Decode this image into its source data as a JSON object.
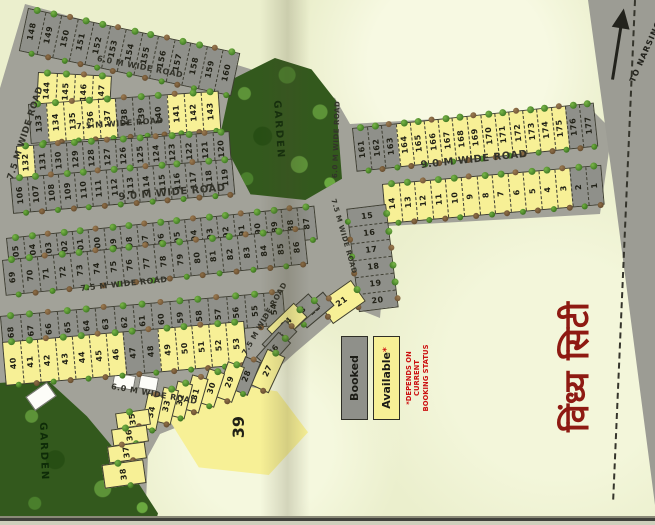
{
  "title": {
    "text": "विंध्य सिटी"
  },
  "direction_sign": {
    "text": "TO NARSINGHPUR"
  },
  "legend": {
    "booked": "Booked",
    "available": "Available",
    "available_mark": "*",
    "note_line1": "*DEPENDS ON CURRENT",
    "note_line2": "BOOKING STATUS"
  },
  "gardens": [
    {
      "label": "GARDEN"
    },
    {
      "label": "GARDEN"
    }
  ],
  "roads": [
    {
      "id": "road-top",
      "label": "6.0 M WIDE ROAD"
    },
    {
      "id": "road-75-upper",
      "label": "7.5 M WIDE ROAD"
    },
    {
      "id": "road-90-left",
      "label": "9.0 M WIDE ROAD"
    },
    {
      "id": "road-75-mid",
      "label": "7.5 M WIDE ROAD"
    },
    {
      "id": "road-60-lower",
      "label": "6.0 M WIDE ROAD"
    },
    {
      "id": "road-90-right",
      "label": "9.0 M WIDE ROAD"
    },
    {
      "id": "road-75-vert",
      "label": "7.5 M WIDE ROAD"
    },
    {
      "id": "road-75-diag",
      "label": "7.5 M WIDE ROAD"
    },
    {
      "id": "road-60-vert",
      "label": "6.0 M WIDE ROAD"
    },
    {
      "id": "road-75-left-edge",
      "label": "7.5 M WIDE ROAD"
    }
  ],
  "colors": {
    "available": "#f7f096",
    "booked": "#8f908a",
    "road": "#a2a299",
    "garden": "#33591d",
    "background": "#ebefcd",
    "title_red": "#8e1a12",
    "note_red": "#cc1111"
  },
  "big_plot": {
    "n": "39",
    "s": "available"
  },
  "rows": [
    {
      "id": "a",
      "plots": [
        {
          "n": "148",
          "s": "booked"
        },
        {
          "n": "149",
          "s": "booked"
        },
        {
          "n": "150",
          "s": "booked"
        },
        {
          "n": "151",
          "s": "booked"
        },
        {
          "n": "152",
          "s": "booked"
        },
        {
          "n": "153",
          "s": "booked"
        },
        {
          "n": "154",
          "s": "booked"
        },
        {
          "n": "155",
          "s": "booked"
        },
        {
          "n": "156",
          "s": "booked"
        },
        {
          "n": "157",
          "s": "booked"
        },
        {
          "n": "158",
          "s": "booked"
        },
        {
          "n": "159",
          "s": "booked"
        },
        {
          "n": "160",
          "s": "booked"
        }
      ]
    },
    {
      "id": "b1",
      "plots": [
        {
          "n": "144",
          "s": "available"
        },
        {
          "n": "145",
          "s": "available"
        },
        {
          "n": "146",
          "s": "available"
        },
        {
          "n": "147",
          "s": "available"
        }
      ]
    },
    {
      "id": "b2",
      "plots": [
        {
          "n": "133",
          "s": "booked"
        },
        {
          "n": "134",
          "s": "available"
        },
        {
          "n": "135",
          "s": "available"
        },
        {
          "n": "136",
          "s": "available"
        },
        {
          "n": "137",
          "s": "available"
        },
        {
          "n": "138",
          "s": "booked"
        },
        {
          "n": "139",
          "s": "booked"
        },
        {
          "n": "140",
          "s": "booked"
        },
        {
          "n": "141",
          "s": "available"
        },
        {
          "n": "142",
          "s": "available"
        },
        {
          "n": "143",
          "s": "available"
        }
      ]
    },
    {
      "id": "c1",
      "plots": [
        {
          "n": "132",
          "s": "available"
        },
        {
          "n": "131",
          "s": "booked"
        },
        {
          "n": "130",
          "s": "booked"
        },
        {
          "n": "129",
          "s": "booked"
        },
        {
          "n": "128",
          "s": "booked"
        },
        {
          "n": "127",
          "s": "booked"
        },
        {
          "n": "126",
          "s": "booked"
        },
        {
          "n": "125",
          "s": "booked"
        },
        {
          "n": "124",
          "s": "booked"
        },
        {
          "n": "123",
          "s": "booked"
        },
        {
          "n": "122",
          "s": "booked"
        },
        {
          "n": "121",
          "s": "booked"
        },
        {
          "n": "120",
          "s": "booked"
        }
      ]
    },
    {
      "id": "c2",
      "plots": [
        {
          "n": "106",
          "s": "booked"
        },
        {
          "n": "107",
          "s": "booked"
        },
        {
          "n": "108",
          "s": "booked"
        },
        {
          "n": "109",
          "s": "booked"
        },
        {
          "n": "110",
          "s": "booked"
        },
        {
          "n": "111",
          "s": "booked"
        },
        {
          "n": "112",
          "s": "booked"
        },
        {
          "n": "113",
          "s": "booked"
        },
        {
          "n": "114",
          "s": "booked"
        },
        {
          "n": "115",
          "s": "booked"
        },
        {
          "n": "116",
          "s": "booked"
        },
        {
          "n": "117",
          "s": "booked"
        },
        {
          "n": "118",
          "s": "booked"
        },
        {
          "n": "119",
          "s": "booked"
        }
      ]
    },
    {
      "id": "d1",
      "plots": [
        {
          "n": "105",
          "s": "booked"
        },
        {
          "n": "104",
          "s": "booked"
        },
        {
          "n": "103",
          "s": "booked"
        },
        {
          "n": "102",
          "s": "booked"
        },
        {
          "n": "101",
          "s": "booked"
        },
        {
          "n": "100",
          "s": "booked"
        },
        {
          "n": "99",
          "s": "booked"
        },
        {
          "n": "98",
          "s": "booked"
        },
        {
          "n": "97",
          "s": "booked"
        },
        {
          "n": "96",
          "s": "booked"
        },
        {
          "n": "95",
          "s": "booked"
        },
        {
          "n": "94",
          "s": "booked"
        },
        {
          "n": "93",
          "s": "booked"
        },
        {
          "n": "92",
          "s": "booked"
        },
        {
          "n": "91",
          "s": "booked"
        },
        {
          "n": "90",
          "s": "booked"
        },
        {
          "n": "89",
          "s": "booked"
        },
        {
          "n": "88",
          "s": "booked"
        },
        {
          "n": "87",
          "s": "booked"
        }
      ]
    },
    {
      "id": "d2",
      "plots": [
        {
          "n": "69",
          "s": "booked"
        },
        {
          "n": "70",
          "s": "booked"
        },
        {
          "n": "71",
          "s": "booked"
        },
        {
          "n": "72",
          "s": "booked"
        },
        {
          "n": "73",
          "s": "booked"
        },
        {
          "n": "74",
          "s": "booked"
        },
        {
          "n": "75",
          "s": "booked"
        },
        {
          "n": "76",
          "s": "booked"
        },
        {
          "n": "77",
          "s": "booked"
        },
        {
          "n": "78",
          "s": "booked"
        },
        {
          "n": "79",
          "s": "booked"
        },
        {
          "n": "80",
          "s": "booked"
        },
        {
          "n": "81",
          "s": "booked"
        },
        {
          "n": "82",
          "s": "booked"
        },
        {
          "n": "83",
          "s": "booked"
        },
        {
          "n": "84",
          "s": "booked"
        },
        {
          "n": "85",
          "s": "booked"
        },
        {
          "n": "86",
          "s": "booked"
        }
      ]
    },
    {
      "id": "e1",
      "plots": [
        {
          "n": "68",
          "s": "booked"
        },
        {
          "n": "67",
          "s": "booked"
        },
        {
          "n": "66",
          "s": "booked"
        },
        {
          "n": "65",
          "s": "booked"
        },
        {
          "n": "64",
          "s": "booked"
        },
        {
          "n": "63",
          "s": "booked"
        },
        {
          "n": "62",
          "s": "booked"
        },
        {
          "n": "61",
          "s": "booked"
        },
        {
          "n": "60",
          "s": "booked"
        },
        {
          "n": "59",
          "s": "booked"
        },
        {
          "n": "58",
          "s": "booked"
        },
        {
          "n": "57",
          "s": "booked"
        },
        {
          "n": "56",
          "s": "booked"
        },
        {
          "n": "55",
          "s": "booked"
        },
        {
          "n": "54",
          "s": "booked"
        }
      ]
    },
    {
      "id": "e2",
      "plots": [
        {
          "n": "40",
          "s": "available"
        },
        {
          "n": "41",
          "s": "available"
        },
        {
          "n": "42",
          "s": "available"
        },
        {
          "n": "43",
          "s": "available"
        },
        {
          "n": "44",
          "s": "available"
        },
        {
          "n": "45",
          "s": "available"
        },
        {
          "n": "46",
          "s": "available"
        },
        {
          "n": "47",
          "s": "booked"
        },
        {
          "n": "48",
          "s": "booked"
        },
        {
          "n": "49",
          "s": "available"
        },
        {
          "n": "50",
          "s": "available"
        },
        {
          "n": "51",
          "s": "available"
        },
        {
          "n": "52",
          "s": "available"
        },
        {
          "n": "53",
          "s": "available"
        }
      ]
    },
    {
      "id": "g1",
      "plots": [
        {
          "n": "161",
          "s": "booked"
        },
        {
          "n": "162",
          "s": "booked"
        },
        {
          "n": "163",
          "s": "booked"
        },
        {
          "n": "164",
          "s": "available"
        },
        {
          "n": "165",
          "s": "available"
        },
        {
          "n": "166",
          "s": "available"
        },
        {
          "n": "167",
          "s": "available"
        },
        {
          "n": "168",
          "s": "available"
        },
        {
          "n": "169",
          "s": "available"
        },
        {
          "n": "170",
          "s": "available"
        },
        {
          "n": "171",
          "s": "available"
        },
        {
          "n": "172",
          "s": "available"
        },
        {
          "n": "173",
          "s": "available"
        },
        {
          "n": "174",
          "s": "available"
        },
        {
          "n": "175",
          "s": "available"
        },
        {
          "n": "176",
          "s": "booked"
        },
        {
          "n": "177",
          "s": "booked"
        }
      ]
    },
    {
      "id": "g2",
      "plots": [
        {
          "n": "14",
          "s": "available"
        },
        {
          "n": "13",
          "s": "available"
        },
        {
          "n": "12",
          "s": "available"
        },
        {
          "n": "11",
          "s": "available"
        },
        {
          "n": "10",
          "s": "available"
        },
        {
          "n": "9",
          "s": "available"
        },
        {
          "n": "8",
          "s": "available"
        },
        {
          "n": "7",
          "s": "available"
        },
        {
          "n": "6",
          "s": "available"
        },
        {
          "n": "5",
          "s": "available"
        },
        {
          "n": "4",
          "s": "available"
        },
        {
          "n": "3",
          "s": "available"
        },
        {
          "n": "2",
          "s": "booked"
        },
        {
          "n": "1",
          "s": "booked"
        }
      ]
    },
    {
      "id": "h",
      "plots": [
        {
          "n": "15",
          "s": "booked"
        },
        {
          "n": "16",
          "s": "booked"
        },
        {
          "n": "17",
          "s": "booked"
        },
        {
          "n": "18",
          "s": "booked"
        },
        {
          "n": "19",
          "s": "booked"
        },
        {
          "n": "20",
          "s": "booked"
        }
      ]
    }
  ],
  "free_plots": [
    {
      "n": "21",
      "s": "available"
    },
    {
      "n": "22",
      "s": "booked"
    },
    {
      "n": "23",
      "s": "booked"
    },
    {
      "n": "24",
      "s": "available"
    },
    {
      "n": "25",
      "s": "booked"
    },
    {
      "n": "26",
      "s": "booked"
    },
    {
      "n": "27",
      "s": "available"
    },
    {
      "n": "28",
      "s": "booked"
    },
    {
      "n": "29",
      "s": "available"
    },
    {
      "n": "30",
      "s": "available"
    },
    {
      "n": "31",
      "s": "available"
    },
    {
      "n": "32",
      "s": "available"
    },
    {
      "n": "33",
      "s": "available"
    },
    {
      "n": "34",
      "s": "available"
    },
    {
      "n": "35",
      "s": "available"
    },
    {
      "n": "36",
      "s": "available"
    },
    {
      "n": "37",
      "s": "available"
    },
    {
      "n": "38",
      "s": "available"
    }
  ]
}
